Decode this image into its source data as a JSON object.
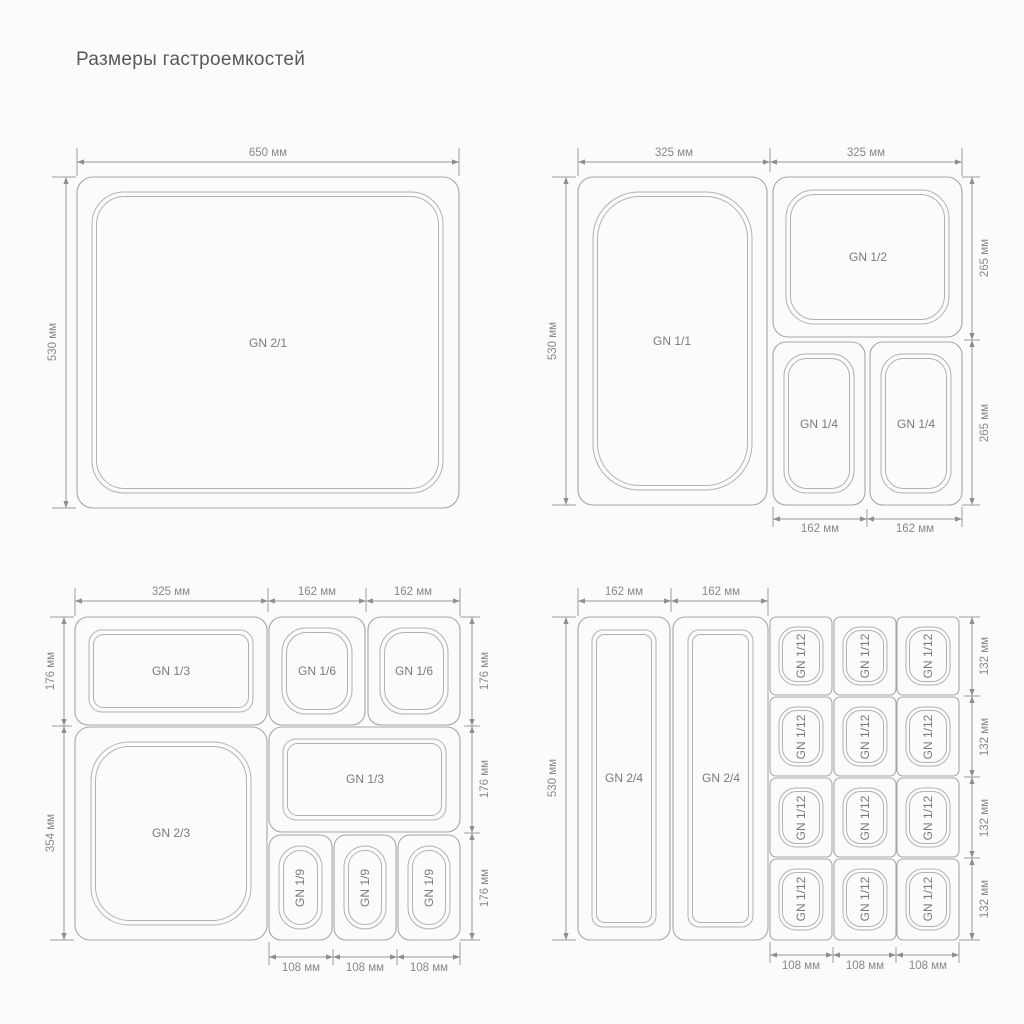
{
  "title": "Размеры гастроемкостей",
  "panels": {
    "p1": {
      "container": "GN 2/1",
      "dims": {
        "top": "650 мм",
        "left": "530 мм"
      }
    },
    "p2": {
      "containers": {
        "gn11": "GN 1/1",
        "gn12": "GN 1/2",
        "gn14a": "GN 1/4",
        "gn14b": "GN 1/4"
      },
      "dims": {
        "top1": "325 мм",
        "top2": "325 мм",
        "left": "530 мм",
        "right1": "265 мм",
        "right2": "265 мм",
        "bottom1": "162 мм",
        "bottom2": "162 мм"
      }
    },
    "p3": {
      "containers": {
        "gn13a": "GN 1/3",
        "gn16a": "GN 1/6",
        "gn16b": "GN 1/6",
        "gn23": "GN 2/3",
        "gn13b": "GN 1/3",
        "gn19a": "GN 1/9",
        "gn19b": "GN 1/9",
        "gn19c": "GN 1/9"
      },
      "dims": {
        "top1": "325 мм",
        "top2": "162 мм",
        "top3": "162 мм",
        "left1": "176 мм",
        "left2": "354 мм",
        "right1": "176 мм",
        "right2": "176 мм",
        "right3": "176 мм",
        "bottom1": "108 мм",
        "bottom2": "108 мм",
        "bottom3": "108 мм"
      }
    },
    "p4": {
      "containers": {
        "gn24a": "GN 2/4",
        "gn24b": "GN 2/4",
        "cells": [
          "GN 1/12",
          "GN 1/12",
          "GN 1/12",
          "GN 1/12",
          "GN 1/12",
          "GN 1/12",
          "GN 1/12",
          "GN 1/12",
          "GN 1/12",
          "GN 1/12",
          "GN 1/12",
          "GN 1/12"
        ]
      },
      "dims": {
        "top1": "162 мм",
        "top2": "162 мм",
        "left": "530 мм",
        "right1": "132 мм",
        "right2": "132 мм",
        "right3": "132 мм",
        "right4": "132 мм",
        "bottom1": "108 мм",
        "bottom2": "108 мм",
        "bottom3": "108 мм"
      }
    }
  }
}
